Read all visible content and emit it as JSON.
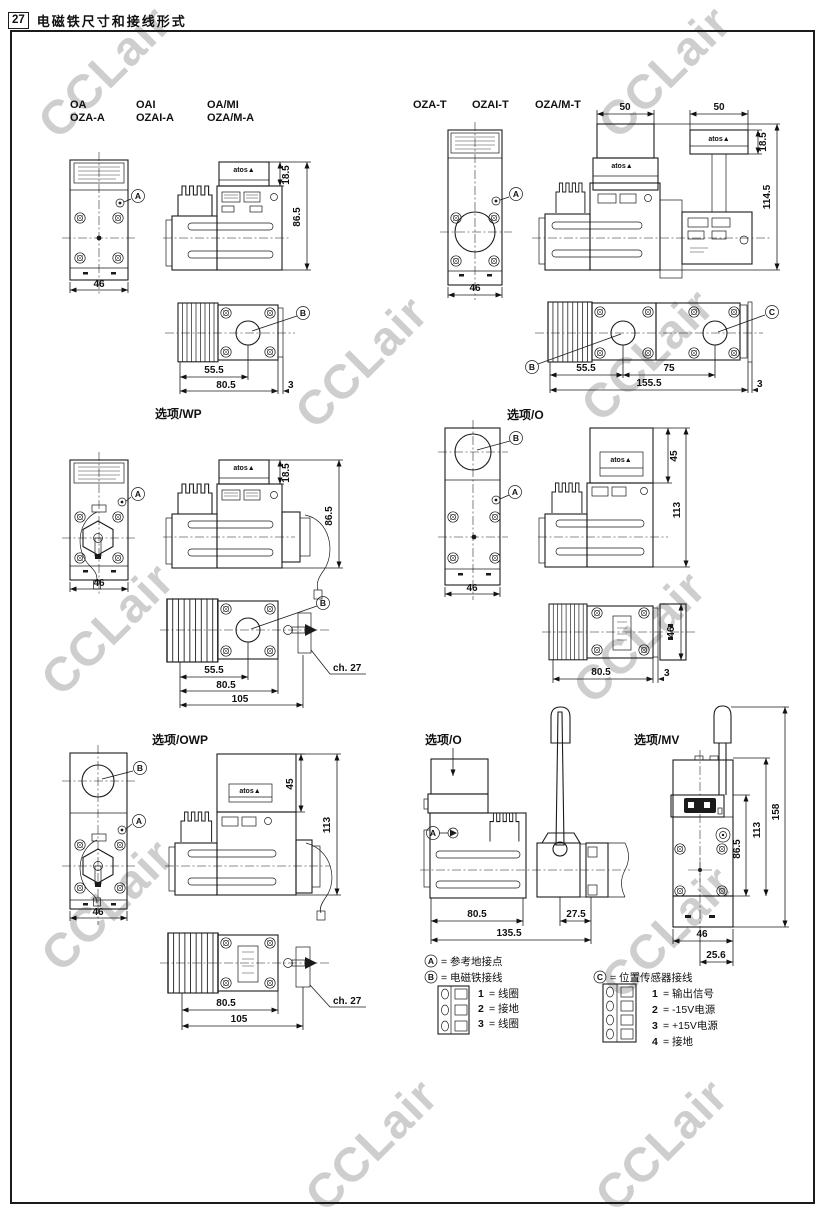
{
  "header": {
    "page_no": "27",
    "title": "电磁铁尺寸和接线形式"
  },
  "watermark": {
    "text": "CCLair"
  },
  "brand": {
    "logo": "atos▲"
  },
  "markers": {
    "a": "A",
    "b": "B",
    "c": "C"
  },
  "g1": {
    "m1a": "OA",
    "m1b": "OZA-A",
    "m2a": "OAI",
    "m2b": "OZAI-A",
    "m3a": "OA/MI",
    "m3b": "OZA/M-A",
    "w": "46",
    "ch": "18.5",
    "h": "86.5",
    "x1": "55.5",
    "x2": "80.5",
    "x3": "3"
  },
  "g2": {
    "m1": "OZA-T",
    "m2": "OZAI-T",
    "m3": "OZA/M-T",
    "c1": "50",
    "c2": "50",
    "w": "46",
    "ch": "18.5",
    "h": "114.5",
    "x1": "55.5",
    "x2": "75",
    "x3": "155.5",
    "x4": "3"
  },
  "g3": {
    "title": "选项/WP",
    "w": "46",
    "ch": "18.5",
    "h": "86.5",
    "x1": "55.5",
    "x2": "80.5",
    "x3": "105",
    "hex": "ch. 27"
  },
  "g4": {
    "title": "选项/O",
    "w": "46",
    "th": "45",
    "h": "113",
    "x1": "80.5",
    "x2": "3",
    "d": "46"
  },
  "g5": {
    "title": "选项/OWP",
    "w": "46",
    "th": "45",
    "h": "113",
    "x1": "80.5",
    "x2": "105",
    "hex": "ch. 27"
  },
  "g6": {
    "title": "选项/O",
    "x1": "80.5",
    "x2": "27.5",
    "x3": "135.5"
  },
  "g7": {
    "title": "选项/MV",
    "h1": "158",
    "h2": "113",
    "h3": "86.5",
    "w": "46",
    "off": "25.6"
  },
  "legend": {
    "a_label": "= 参考地接点",
    "b_label": "= 电磁铁接线",
    "c_label": "= 位置传感器接线",
    "b_pins": [
      {
        "n": "1",
        "t": "= 线圈"
      },
      {
        "n": "2",
        "t": "= 接地"
      },
      {
        "n": "3",
        "t": "= 线圈"
      }
    ],
    "c_pins": [
      {
        "n": "1",
        "t": "= 输出信号"
      },
      {
        "n": "2",
        "t": "= -15V电源"
      },
      {
        "n": "3",
        "t": "= +15V电源"
      },
      {
        "n": "4",
        "t": "= 接地"
      }
    ]
  }
}
